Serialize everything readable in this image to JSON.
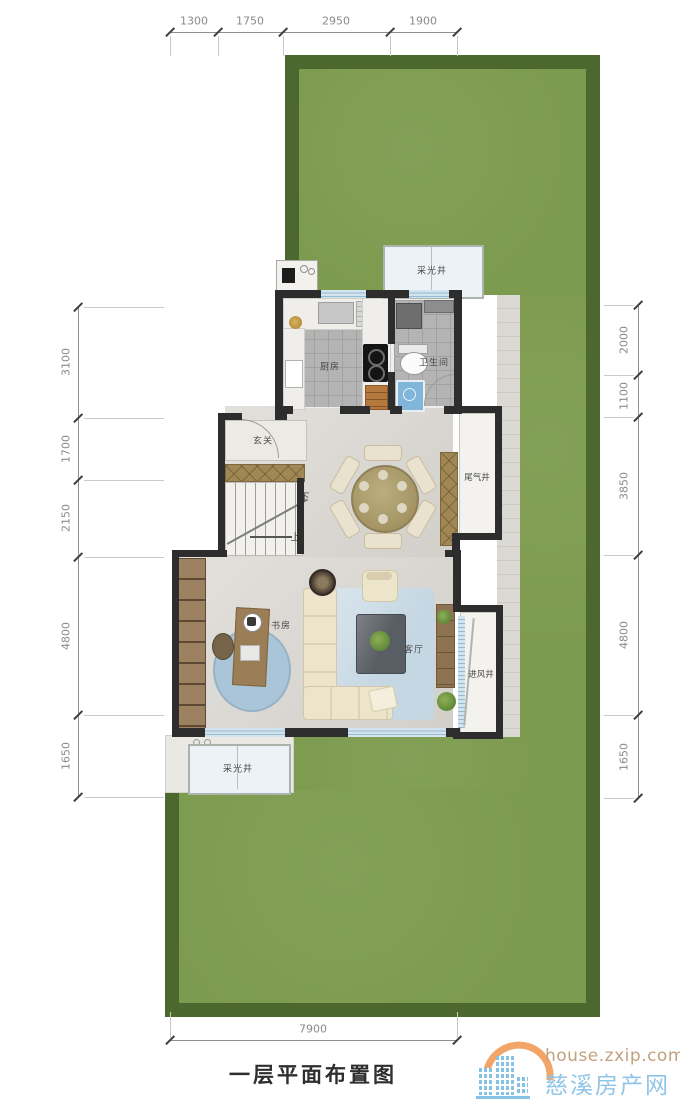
{
  "title": "一层平面布置图",
  "logo": {
    "url": "house.zxip.com",
    "site": "慈溪房产网"
  },
  "dimensions": {
    "top": [
      "1300",
      "1750",
      "2950",
      "1900"
    ],
    "left": [
      "3100",
      "1700",
      "2150",
      "4800",
      "1650"
    ],
    "right": [
      "2000",
      "1100",
      "3850",
      "4800",
      "1650"
    ],
    "bottom": "7900"
  },
  "rooms": {
    "kitchen": "厨房",
    "bathroom": "卫生间",
    "foyer": "玄关",
    "dining": "餐厅",
    "exhaust_shaft": "尾气井",
    "study": "书房",
    "living": "客厅",
    "air_inlet_shaft": "进风井",
    "light_well": "采光井",
    "stairs_down": "下",
    "stairs_up": "上"
  },
  "colors": {
    "lawn": "#7d9b4f",
    "hedge": "#4c682e",
    "wall": "#2d2d2d",
    "logo_orange": "#f2a566",
    "logo_blue": "#90c5e8"
  }
}
